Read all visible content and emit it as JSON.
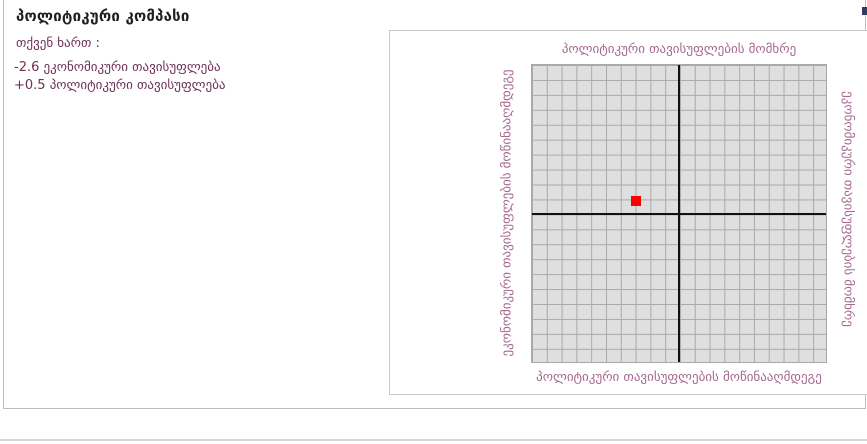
{
  "page": {
    "title": "პოლიტიკური კომპასი",
    "intro": "თქვენ ხართ :",
    "scores": [
      "-2.6 ეკონომიკური თავისუფლება",
      "+0.5 პოლიტიკური თავისუფლება"
    ]
  },
  "chart_data": {
    "type": "scatter",
    "title": "",
    "xlabel_positive": "ეკონომიკური თავისუფლების მომხრე",
    "ylabel_positive": "პოლიტიკური თავისუფლების მომხრე",
    "xlim": [
      -10,
      10
    ],
    "ylim": [
      -10,
      10
    ],
    "grid": true,
    "grid_step": 1,
    "points": [
      {
        "x": -2.6,
        "y": 0.5,
        "color": "#ff0000"
      }
    ],
    "axis_labels": {
      "top": "პოლიტიკური თავისუფლების მომხრე",
      "bottom": "პოლიტიკური თავისუფლების მოწინააღმდეგე",
      "left": "ეკონომიკური თავისუფლების მოწინააღმდეგე",
      "right": "ეკონომიკური თავისუფლების მომხრე"
    }
  },
  "colors": {
    "text_plum": "#6d3156",
    "label_mauve": "#a5688f",
    "point_red": "#ff0000",
    "axis_black": "#111111"
  }
}
